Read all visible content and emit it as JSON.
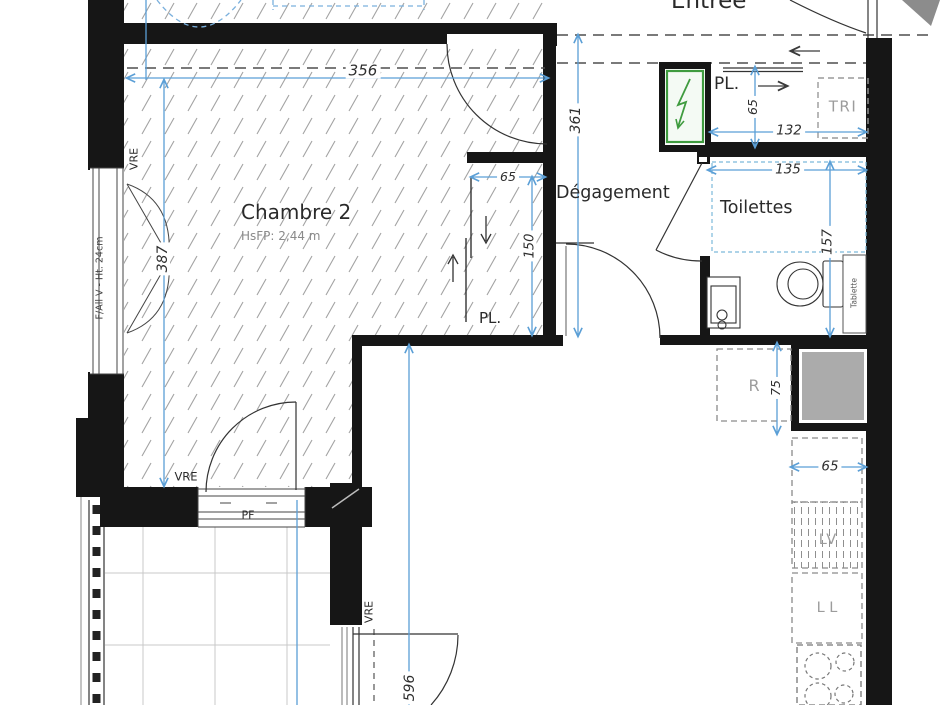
{
  "rooms": {
    "chambre2": {
      "name": "Chambre 2",
      "height_note": "HsFP: 2,44 m"
    },
    "degagement": {
      "name": "Dégagement"
    },
    "toilettes": {
      "name": "Toilettes"
    },
    "entree": {
      "name": "Entrée"
    }
  },
  "annotations": {
    "vre_left": "VRE",
    "vre_bottom": "VRE",
    "vre_sejour": "VRE",
    "window_left": "F/All V - Ht. 24cm",
    "pf": "PF",
    "closet_chambre": "PL.",
    "closet_entree": "PL.",
    "tri": "TRI",
    "fridge": "R",
    "dishwasher": "LV",
    "washer": "L L",
    "shelf": "Tablette"
  },
  "dimensions_cm": {
    "chambre_width": "356",
    "chambre_depth": "387",
    "closet_width": "65",
    "closet_depth": "150",
    "hall_length": "361",
    "entry_closet_depth": "65",
    "entry_closet_width": "132",
    "toilettes_width": "135",
    "toilettes_depth": "157",
    "fridge_width": "75",
    "counter_width": "65",
    "sejour_length": "596"
  },
  "colors": {
    "wall": "#161616",
    "dimension_blue": "#5b9fd6",
    "panel_green": "#3f9b3f",
    "shaft_gray": "#ababab",
    "hatch_gray": "#a3a3a3"
  }
}
